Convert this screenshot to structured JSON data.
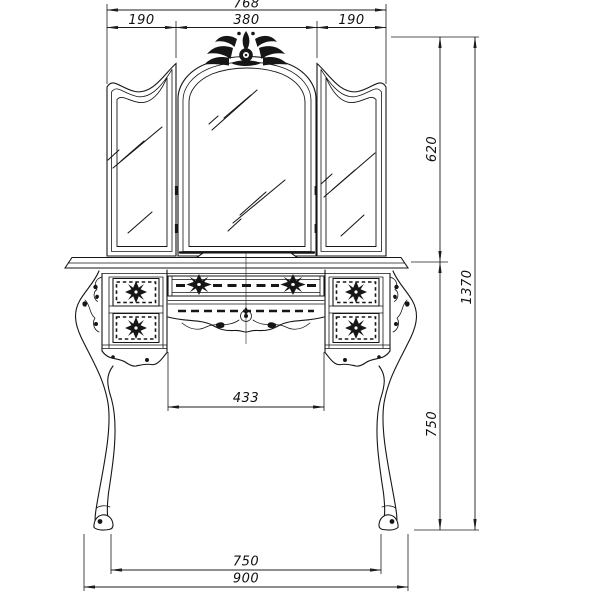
{
  "drawing": {
    "dims": {
      "overall_width": "768",
      "left_mirror_width": "190",
      "center_mirror_width": "380",
      "right_mirror_width": "190",
      "mirror_height": "620",
      "overall_height": "1370",
      "table_height": "750",
      "knee_space_width": "433",
      "foot_span": "750",
      "base_width": "900"
    }
  }
}
